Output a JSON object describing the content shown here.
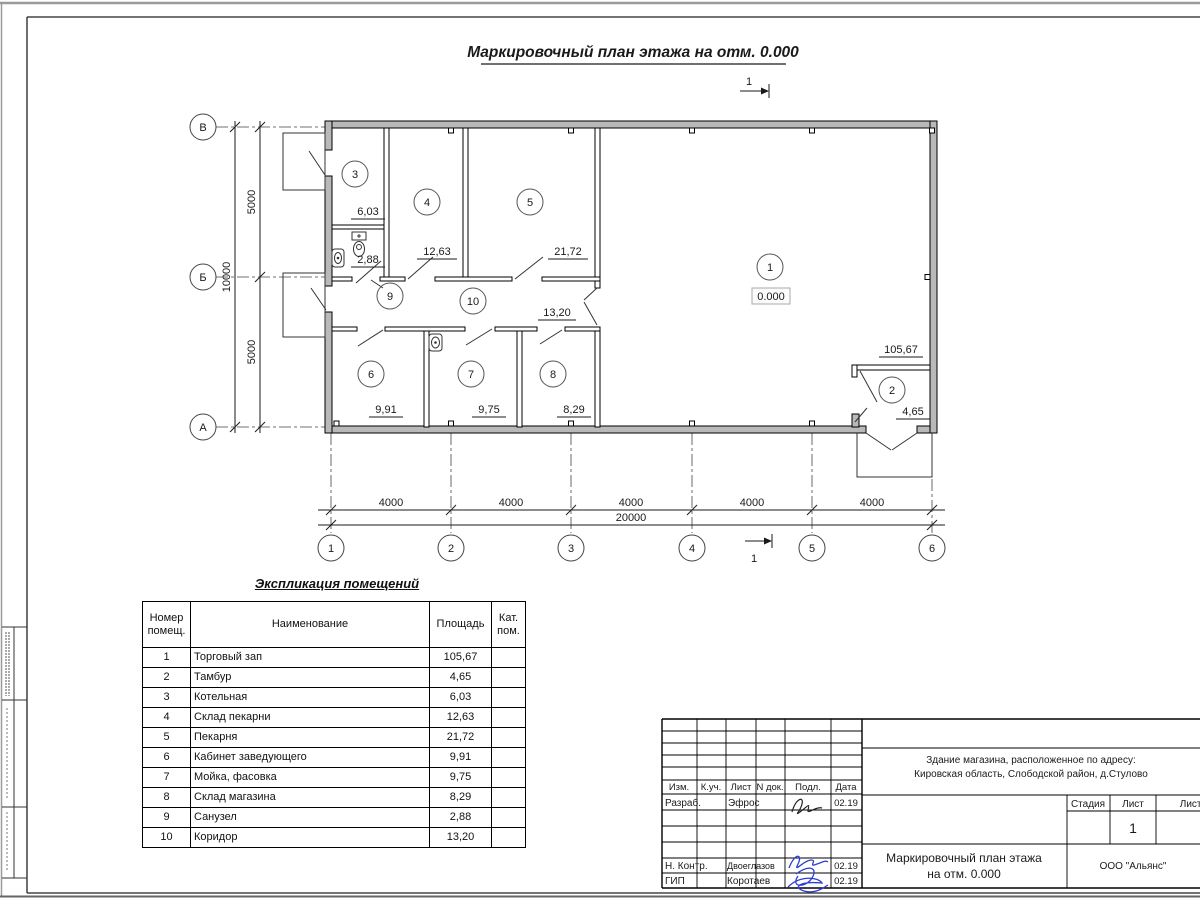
{
  "drawing_title": "Маркировочный план этажа на отм. 0.000",
  "level_mark": "0.000",
  "section_mark": "1",
  "axes": {
    "rows": [
      "В",
      "Б",
      "А"
    ],
    "cols": [
      "1",
      "2",
      "3",
      "4",
      "5",
      "6"
    ]
  },
  "dims": {
    "horizontal": [
      "4000",
      "4000",
      "4000",
      "4000",
      "4000"
    ],
    "horizontal_total": "20000",
    "vertical": [
      "5000",
      "5000"
    ],
    "vertical_total": "10000"
  },
  "rooms": [
    {
      "num": "1",
      "name": "Торговый зап",
      "area": "105,67"
    },
    {
      "num": "2",
      "name": "Тамбур",
      "area": "4,65"
    },
    {
      "num": "3",
      "name": "Котельная",
      "area": "6,03"
    },
    {
      "num": "4",
      "name": "Склад пекарни",
      "area": "12,63"
    },
    {
      "num": "5",
      "name": "Пекарня",
      "area": "21,72"
    },
    {
      "num": "6",
      "name": "Кабинет заведующего",
      "area": "9,91"
    },
    {
      "num": "7",
      "name": "Мойка, фасовка",
      "area": "9,75"
    },
    {
      "num": "8",
      "name": "Склад магазина",
      "area": "8,29"
    },
    {
      "num": "9",
      "name": "Санузел",
      "area": "2,88"
    },
    {
      "num": "10",
      "name": "Коридор",
      "area": "13,20"
    }
  ],
  "table": {
    "title": "Экспликация помещений",
    "headers": {
      "num": "Номер помещ.",
      "name": "Наименование",
      "area": "Площадь",
      "cat": "Кат. пом."
    }
  },
  "stamp": {
    "header_cells": [
      "Изм.",
      "К.уч.",
      "Лист",
      "N док.",
      "Подл.",
      "Дата"
    ],
    "sign_rows": [
      {
        "role": "Разраб.",
        "name": "Эфрос",
        "date": "02.19"
      },
      {
        "role": "Н. Контр.",
        "name": "Двоеглазов",
        "date": "02.19"
      },
      {
        "role": "ГИП",
        "name": "Коротаев",
        "date": "02.19"
      }
    ],
    "address_line1": "Здание магазина, расположенное по адресу:",
    "address_line2": "Кировская область, Слободской район, д.Стулово",
    "stage_label": "Стадия",
    "sheet_label": "Лист",
    "sheets_label": "Листов",
    "sheet_number": "1",
    "doc_title_line1": "Маркировочный план этажа",
    "doc_title_line2": "на отм. 0.000",
    "company": "ООО \"Альянс\""
  }
}
